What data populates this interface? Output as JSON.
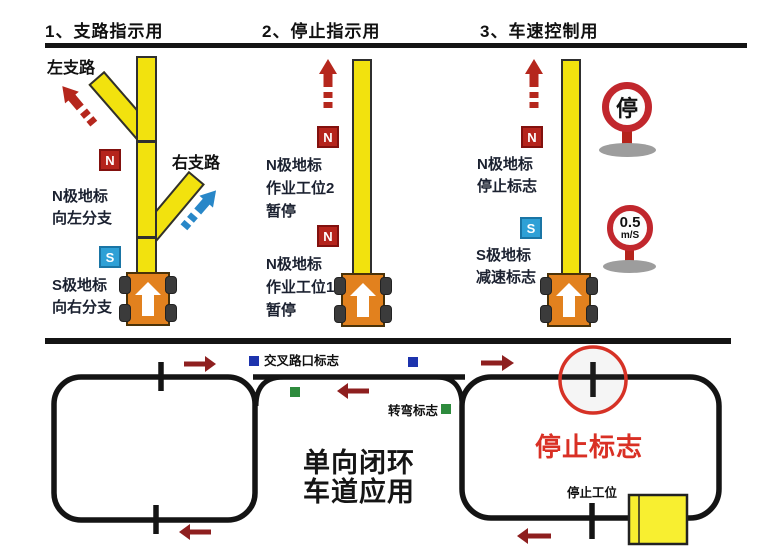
{
  "badges": {
    "n": "N",
    "s": "S"
  },
  "panel1": {
    "title": "1、支路指示用",
    "left_branch_label": "左支路",
    "right_branch_label": "右支路",
    "n_note": "N极地标\n向左分支",
    "s_note": "S极地标\n向右分支"
  },
  "panel2": {
    "title": "2、停止指示用",
    "n_note_upper": "N极地标\n作业工位2\n暂停",
    "n_note_lower": "N极地标\n作业工位1\n暂停"
  },
  "panel3": {
    "title": "3、车速控制用",
    "n_note": "N极地标\n停止标志",
    "s_note": "S极地标\n减速标志",
    "stop_sign_text": "停",
    "speed_sign_value": "0.5",
    "speed_sign_unit": "m/S"
  },
  "loop_diagram": {
    "intersection_marker_label": "交叉路口标志",
    "turn_marker_label": "转弯标志",
    "stop_marker_label": "停止标志",
    "stop_station_label": "停止工位",
    "caption": "单向闭环\n车道应用"
  },
  "colors": {
    "tape_yellow": "#f2e20e",
    "agv_orange": "#e2811e",
    "n_badge_red": "#b5241c",
    "s_badge_blue": "#2ea0d6",
    "dashed_arrow_red": "#b5271d",
    "dashed_arrow_blue": "#2887c8",
    "flow_arrow_dark_red": "#8e1f1f",
    "sign_ring_red": "#c1272d",
    "highlight_circle_red": "#d63226",
    "marker_blue": "#1d33ad",
    "marker_green": "#2e8b3d",
    "track_black": "#141414",
    "stop_text_red": "#d93025"
  }
}
